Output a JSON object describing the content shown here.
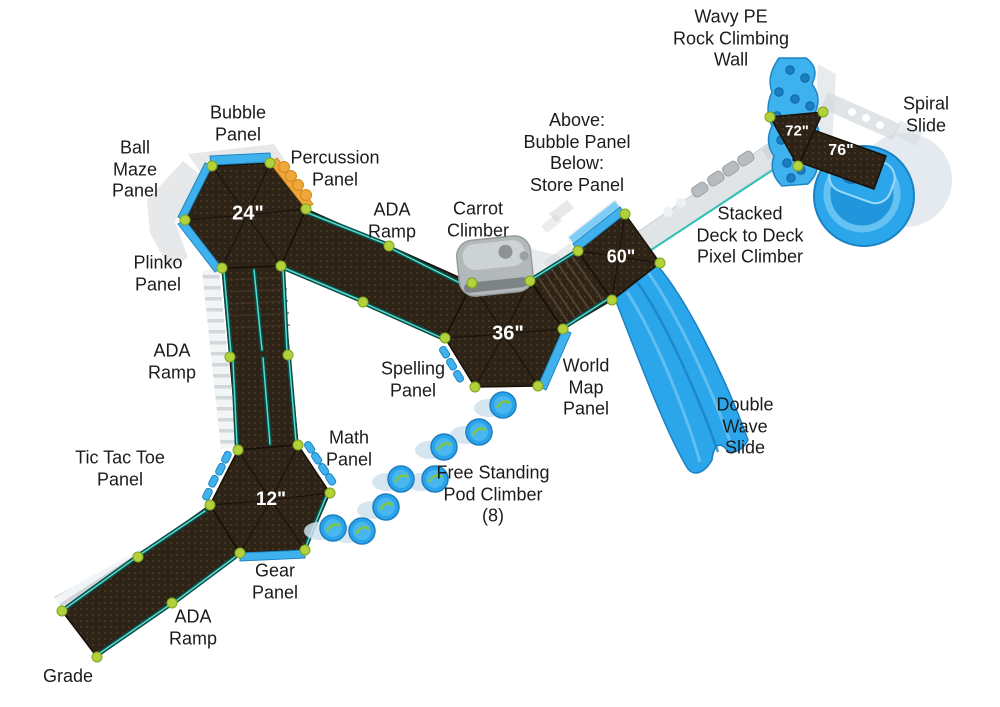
{
  "diagram": {
    "type": "playground-equipment-top-view-plan",
    "labels": {
      "wavy_pe": "Wavy PE\nRock Climbing\nWall",
      "spiral": "Spiral\nSlide",
      "bubble": "Bubble\nPanel",
      "ball_maze": "Ball\nMaze\nPanel",
      "percussion": "Percussion\nPanel",
      "ada_top": "ADA\nRamp",
      "carrot": "Carrot\nClimber",
      "above_below": "Above:\nBubble Panel\nBelow:\nStore Panel",
      "stacked": "Stacked\nDeck to Deck\nPixel Climber",
      "plinko": "Plinko\nPanel",
      "ada_left": "ADA\nRamp",
      "spelling": "Spelling\nPanel",
      "world_map": "World\nMap\nPanel",
      "double_wave": "Double\nWave\nSlide",
      "tic_tac_toe": "Tic Tac Toe\nPanel",
      "math": "Math\nPanel",
      "pod_climber": "Free Standing\nPod Climber\n(8)",
      "gear": "Gear\nPanel",
      "ada_bottom": "ADA\nRamp",
      "grade": "Grade"
    },
    "deck_heights": {
      "d24": "24\"",
      "d36": "36\"",
      "d12": "12\"",
      "d60": "60\"",
      "d72": "72\"",
      "d76": "76\""
    },
    "colors": {
      "deck_brown": "#2d2316",
      "rail_teal": "#0c4b45",
      "rail_highlight": "#56dbd0",
      "post_green": "#b3d13b",
      "slide_blue": "#2ba6ea",
      "panel_blue": "#3fb2ee",
      "panel_orange": "#f0a73a",
      "ghost_gray": "#cdd2d6",
      "pod_swirl_green": "#7fc741",
      "label_text": "#1b1b1b"
    }
  }
}
